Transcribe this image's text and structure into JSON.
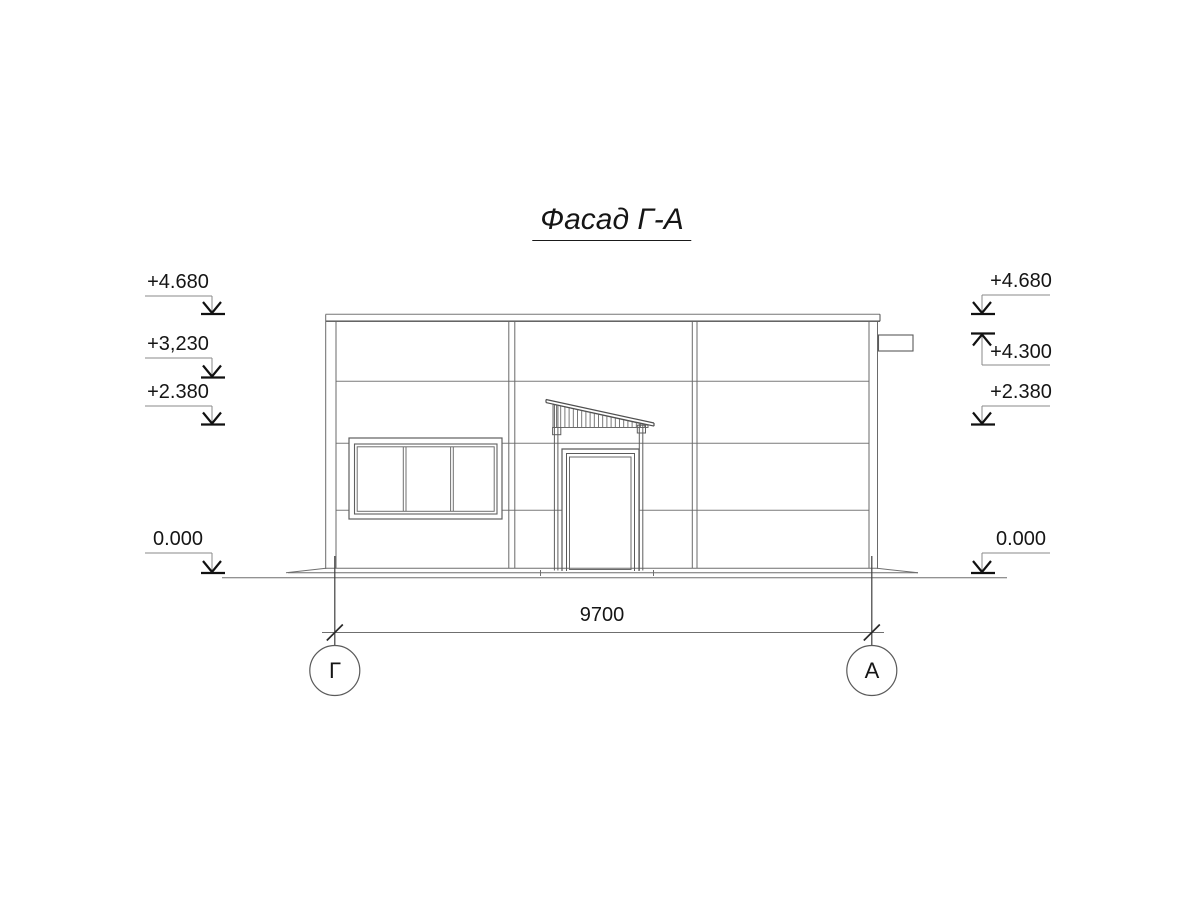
{
  "title": "Фасад Г-А",
  "levels": {
    "left": [
      "+4.680",
      "+3,230",
      "+2.380",
      "0.000"
    ],
    "right": [
      "+4.680",
      "+4.300",
      "+2.380",
      "0.000"
    ]
  },
  "dimension": "9700",
  "axes": {
    "left": "Г",
    "right": "А"
  },
  "colors": {
    "background": "#ffffff",
    "thin_line": "#7a7a7a",
    "medium_line": "#555555",
    "heavy_line": "#161616",
    "text": "#151515"
  }
}
